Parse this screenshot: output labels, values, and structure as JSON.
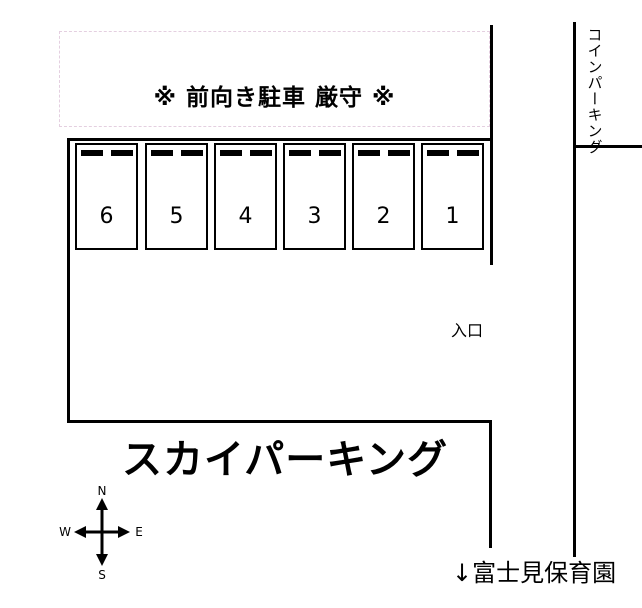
{
  "banner": {
    "text": "※ 前向き駐車 厳守 ※",
    "border_color": "#e4cfe0"
  },
  "parking": {
    "numbers": [
      "6",
      "5",
      "4",
      "3",
      "2",
      "1"
    ]
  },
  "labels": {
    "entrance": "入口",
    "title": "スカイパーキング",
    "coin_parking": "コインパーキング",
    "nursery": "↓富士見保育園"
  },
  "compass": {
    "north": "N",
    "south": "S",
    "east": "E",
    "west": "W"
  },
  "colors": {
    "line": "#000000",
    "background": "#ffffff",
    "banner_border": "#e4cfe0"
  }
}
